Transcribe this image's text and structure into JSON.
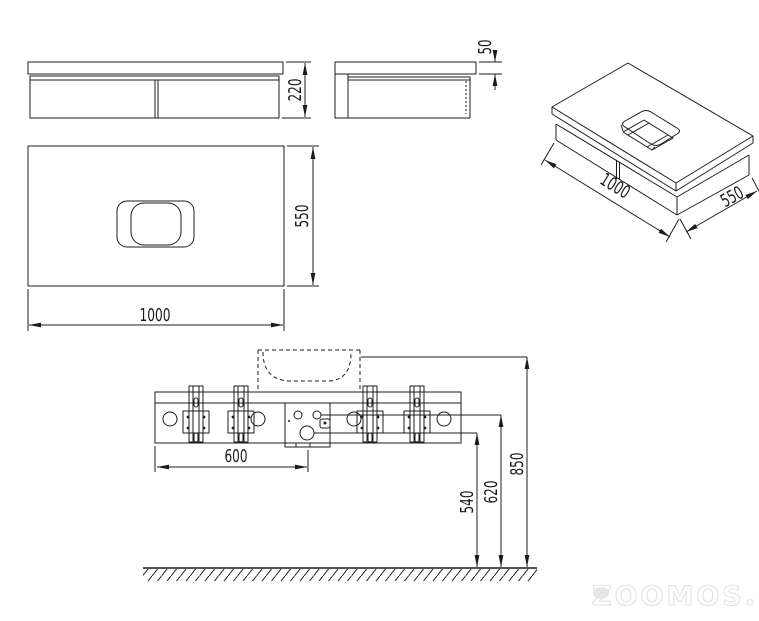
{
  "dims": {
    "front_height": "220",
    "side_countertop": "50",
    "plan_depth": "550",
    "plan_width": "1000",
    "iso_width": "1000",
    "iso_depth": "550",
    "install_span": "600",
    "install_drain_height": "540",
    "install_supply_height": "620",
    "install_total_height": "850"
  },
  "watermark": {
    "text": "ZOOMOS.OY"
  },
  "colors": {
    "line": "#1c1c1c",
    "watermark": "#e3e3e3",
    "background": "#ffffff"
  }
}
